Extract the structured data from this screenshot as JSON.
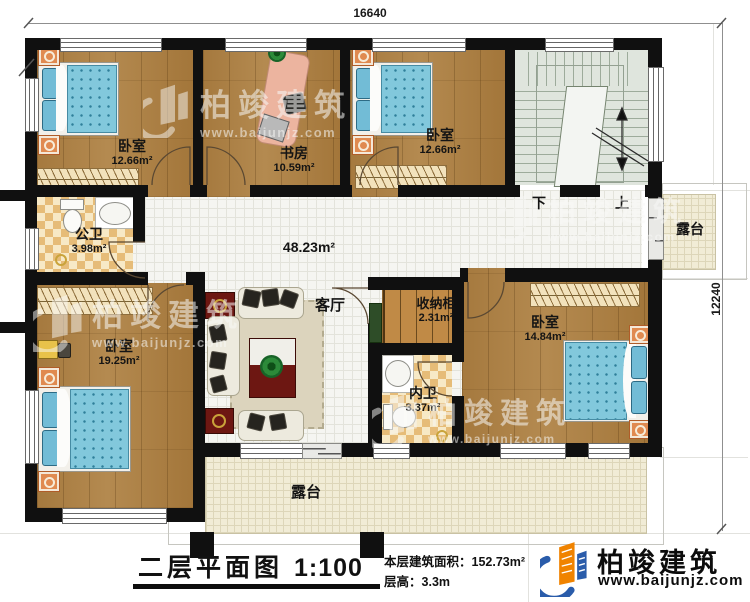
{
  "plan": {
    "dimensions": {
      "top_width": "16640",
      "right_height": "12240"
    },
    "rooms": [
      {
        "id": "bedroom-top-left",
        "name": "卧室",
        "area": "12.66m²"
      },
      {
        "id": "study",
        "name": "书房",
        "area": "10.59m²"
      },
      {
        "id": "bedroom-top-right",
        "name": "卧室",
        "area": "12.66m²"
      },
      {
        "id": "public-bathroom",
        "name": "公卫",
        "area": "3.98m²"
      },
      {
        "id": "hall-living-room",
        "name": "客厅",
        "area": "48.23m²"
      },
      {
        "id": "bedroom-left",
        "name": "卧室",
        "area": "19.25m²"
      },
      {
        "id": "storage-cabinet",
        "name": "收纳柜",
        "area": "2.31m²"
      },
      {
        "id": "bedroom-right",
        "name": "卧室",
        "area": "14.84m²"
      },
      {
        "id": "inner-bathroom",
        "name": "内卫",
        "area": "3.37m²"
      },
      {
        "id": "terrace-right",
        "name": "露台",
        "area": ""
      },
      {
        "id": "terrace-bottom",
        "name": "露台",
        "area": ""
      }
    ],
    "stairs": {
      "down_label": "下",
      "up_label": "上"
    }
  },
  "title_block": {
    "title": "二层平面图",
    "scale": "1:100",
    "stats": [
      {
        "label": "本层建筑面积：",
        "value": "152.73m²"
      },
      {
        "label": "层高：",
        "value": "3.3m"
      }
    ]
  },
  "branding": {
    "name": "柏竣建筑",
    "website": "www.baijunjz.com"
  },
  "colors": {
    "wall": "#101010",
    "wood_floor": "#a87c42",
    "bath_tile_dark": "#e6bc78",
    "bath_tile_light": "#f7e9c6",
    "hall_tile": "#f5f5f1",
    "stair_floor": "#dfe5dd",
    "terrace": "#f1ecd6",
    "mattress_blue": "#82c8dc",
    "nightstand_orange": "#e08a50",
    "table_red": "#6d1712",
    "logo_orange": "#f08300",
    "logo_blue": "#2a5caa"
  }
}
